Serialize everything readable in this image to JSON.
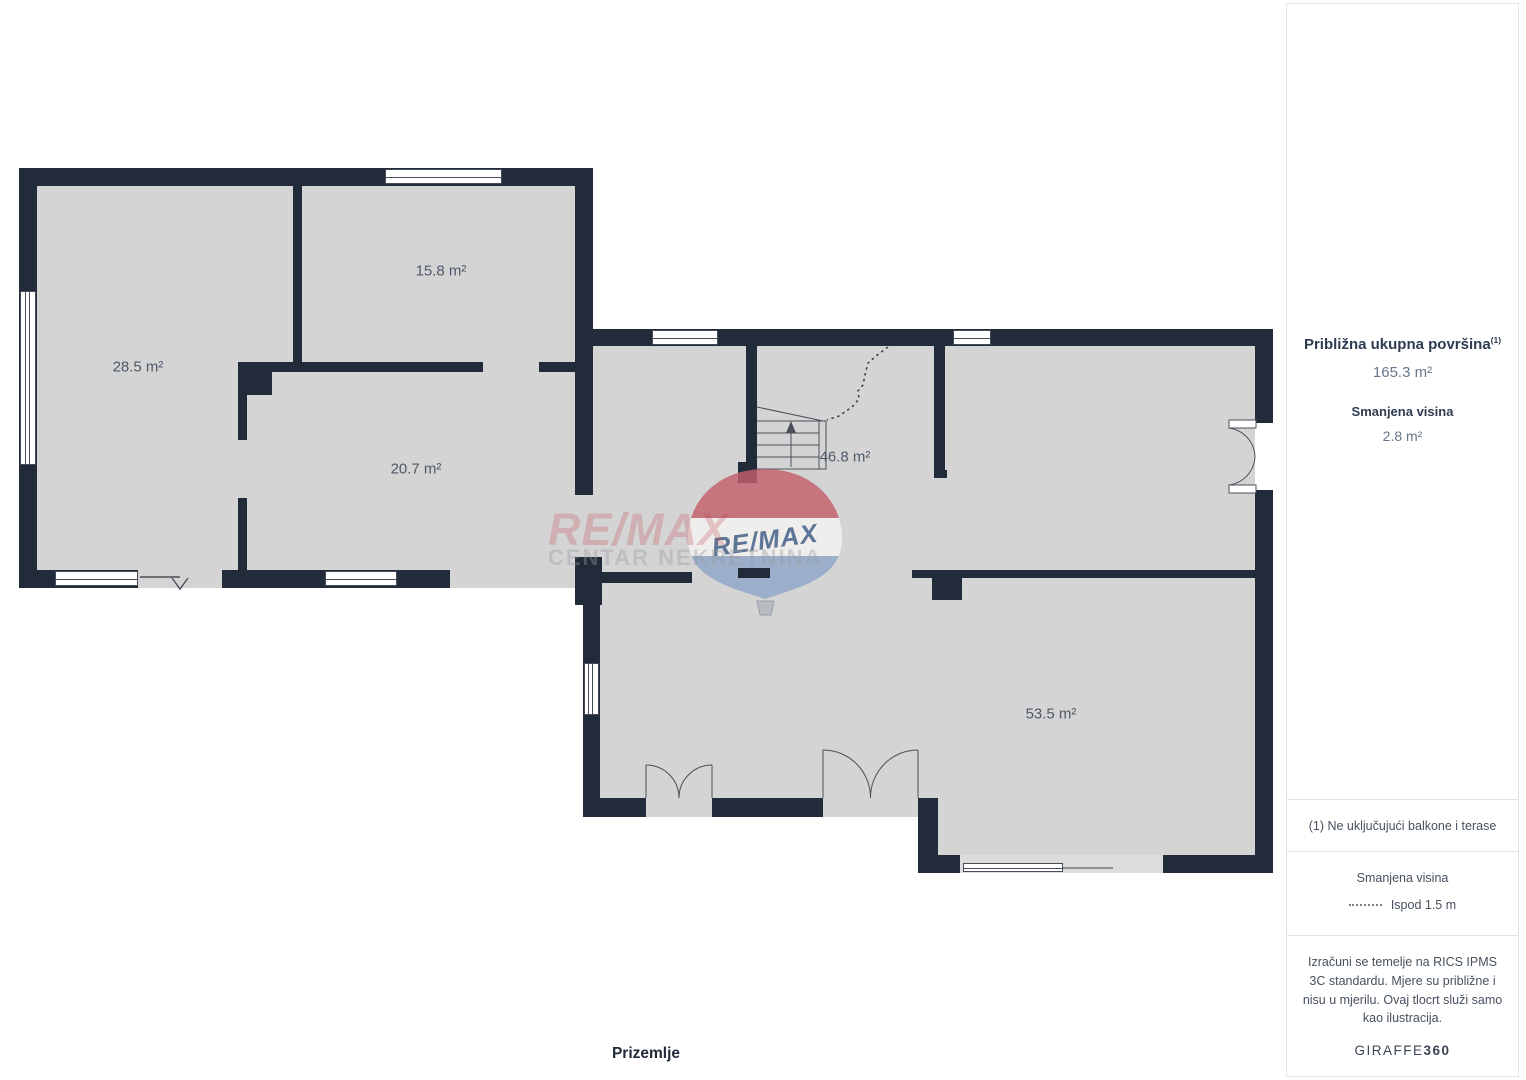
{
  "floorplan": {
    "floor_label": "Prizemlje",
    "rooms": [
      {
        "area": "28.5 m²"
      },
      {
        "area": "15.8 m²"
      },
      {
        "area": "20.7 m²"
      },
      {
        "area": "46.8 m²"
      },
      {
        "area": "53.5 m²"
      }
    ],
    "watermark": {
      "brand": "RE/MAX",
      "subtitle": "CENTAR NEKRETNINA",
      "balloon_label": "RE/MAX"
    }
  },
  "sidebar": {
    "total_area_label": "Približna ukupna površina",
    "total_area_superscript": "(1)",
    "total_area_value": "165.3 m²",
    "reduced_height_label": "Smanjena visina",
    "reduced_height_value": "2.8 m²",
    "footnote": "(1) Ne uključujući balkone i terase",
    "legend_title": "Smanjena visina",
    "legend_value": "Ispod 1.5 m",
    "disclaimer": "Izračuni se temelje na RICS IPMS 3C standardu. Mjere su približne i nisu u mjerilu. Ovaj tlocrt služi samo kao ilustracija.",
    "brand": "GIRAFFE",
    "brand_bold": "360"
  },
  "colors": {
    "wall": "#212b3a",
    "floor": "#d4d4d5",
    "floor_light": "#dcdcdd",
    "text_dark": "#2e3b50",
    "text_muted": "#67768a",
    "note_text": "#47525f",
    "divider": "#e4e4e4",
    "plan_line": "#4a4f57",
    "watermark_red": "rgba(190,62,75,0.25)",
    "watermark_gray": "rgba(152,155,161,0.38)",
    "balloon_red": "#c4606c",
    "balloon_blue": "#8fa8c8",
    "balloon_text": "#44618a"
  }
}
